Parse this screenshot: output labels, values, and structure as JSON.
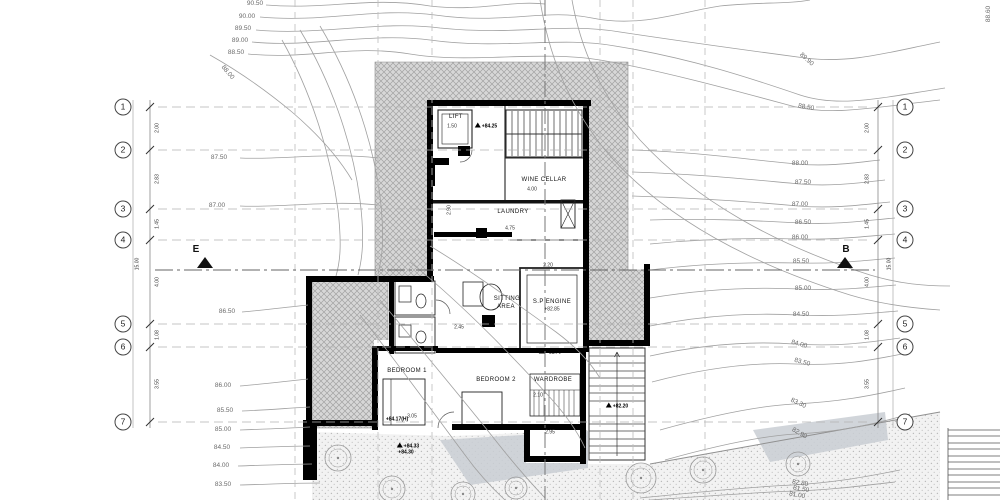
{
  "section_markers": {
    "left": "E",
    "right": "B"
  },
  "grid": {
    "row_numbers": [
      "1",
      "2",
      "3",
      "4",
      "5",
      "6",
      "7"
    ],
    "interval_dims": [
      "2.00",
      "2.83",
      "1.45",
      "4.00",
      "1.08",
      "3.55"
    ],
    "overall_dim": "15.00"
  },
  "rooms": [
    "LIFT",
    "WINE CELLAR",
    "LAUNDRY",
    "SITTING AREA",
    "S.P ENGINE",
    "BEDROOM 1",
    "BEDROOM 2",
    "WARDROBE"
  ],
  "level_markers": [
    "+84.25",
    "+82.85",
    "+82.75",
    "+82.20",
    "+84.33",
    "+84.30",
    "+84.17(H)"
  ],
  "contour_elevations": [
    "90.50",
    "90.00",
    "89.50",
    "89.00",
    "88.50",
    "88.00",
    "87.50",
    "87.00",
    "86.50",
    "86.00",
    "85.50",
    "85.00",
    "84.50",
    "84.00",
    "83.50",
    "83.30",
    "82.90",
    "82.80",
    "81.50",
    "81.00",
    "89.90",
    "88.60"
  ],
  "colors": {
    "walls": "#000000",
    "hatch": "#a2a2a2",
    "contour": "#a0a0a0",
    "ramp": "#c9ced3"
  },
  "labels": [
    {
      "t": "1",
      "x": 123,
      "y": 107,
      "c": "bubble"
    },
    {
      "t": "2",
      "x": 123,
      "y": 150,
      "c": "bubble"
    },
    {
      "t": "3",
      "x": 123,
      "y": 209,
      "c": "bubble"
    },
    {
      "t": "4",
      "x": 123,
      "y": 240,
      "c": "bubble"
    },
    {
      "t": "5",
      "x": 123,
      "y": 324,
      "c": "bubble"
    },
    {
      "t": "6",
      "x": 123,
      "y": 347,
      "c": "bubble"
    },
    {
      "t": "7",
      "x": 123,
      "y": 422,
      "c": "bubble"
    },
    {
      "t": "1",
      "x": 905,
      "y": 107,
      "c": "bubble"
    },
    {
      "t": "2",
      "x": 905,
      "y": 150,
      "c": "bubble"
    },
    {
      "t": "3",
      "x": 905,
      "y": 209,
      "c": "bubble"
    },
    {
      "t": "4",
      "x": 905,
      "y": 240,
      "c": "bubble"
    },
    {
      "t": "5",
      "x": 905,
      "y": 324,
      "c": "bubble"
    },
    {
      "t": "6",
      "x": 905,
      "y": 347,
      "c": "bubble"
    },
    {
      "t": "7",
      "x": 905,
      "y": 422,
      "c": "bubble"
    },
    {
      "t": "90.50",
      "x": 255,
      "y": 4,
      "c": "contour"
    },
    {
      "t": "90.00",
      "x": 247,
      "y": 17,
      "c": "contour"
    },
    {
      "t": "89.50",
      "x": 243,
      "y": 29,
      "c": "contour"
    },
    {
      "t": "89.00",
      "x": 240,
      "y": 41,
      "c": "contour"
    },
    {
      "t": "88.50",
      "x": 236,
      "y": 53,
      "c": "contour"
    },
    {
      "t": "88.00",
      "x": 227,
      "y": 73,
      "r": 50,
      "c": "contour"
    },
    {
      "t": "87.50",
      "x": 219,
      "y": 158,
      "c": "contour"
    },
    {
      "t": "87.00",
      "x": 217,
      "y": 206,
      "c": "contour"
    },
    {
      "t": "86.50",
      "x": 227,
      "y": 312,
      "c": "contour"
    },
    {
      "t": "86.00",
      "x": 223,
      "y": 386,
      "c": "contour"
    },
    {
      "t": "85.50",
      "x": 225,
      "y": 411,
      "c": "contour"
    },
    {
      "t": "85.00",
      "x": 223,
      "y": 430,
      "c": "contour"
    },
    {
      "t": "84.50",
      "x": 222,
      "y": 448,
      "c": "contour"
    },
    {
      "t": "84.00",
      "x": 221,
      "y": 466,
      "c": "contour"
    },
    {
      "t": "83.50",
      "x": 223,
      "y": 485,
      "c": "contour"
    },
    {
      "t": "89.90",
      "x": 806,
      "y": 60,
      "r": 42,
      "c": "contour"
    },
    {
      "t": "88.50",
      "x": 806,
      "y": 108,
      "r": 10,
      "c": "contour"
    },
    {
      "t": "88.00",
      "x": 800,
      "y": 164,
      "c": "contour"
    },
    {
      "t": "87.50",
      "x": 803,
      "y": 183,
      "c": "contour"
    },
    {
      "t": "87.00",
      "x": 800,
      "y": 205,
      "c": "contour"
    },
    {
      "t": "86.50",
      "x": 803,
      "y": 223,
      "c": "contour"
    },
    {
      "t": "86.00",
      "x": 800,
      "y": 238,
      "c": "contour"
    },
    {
      "t": "85.50",
      "x": 801,
      "y": 262,
      "c": "contour"
    },
    {
      "t": "85.00",
      "x": 803,
      "y": 289,
      "c": "contour"
    },
    {
      "t": "84.50",
      "x": 801,
      "y": 315,
      "c": "contour"
    },
    {
      "t": "84.00",
      "x": 799,
      "y": 345,
      "r": 15,
      "c": "contour"
    },
    {
      "t": "83.50",
      "x": 802,
      "y": 363,
      "r": 15,
      "c": "contour"
    },
    {
      "t": "83.30",
      "x": 798,
      "y": 404,
      "r": 25,
      "c": "contour"
    },
    {
      "t": "82.90",
      "x": 799,
      "y": 434,
      "r": 30,
      "c": "contour"
    },
    {
      "t": "82.80",
      "x": 800,
      "y": 484,
      "r": 10,
      "c": "contour"
    },
    {
      "t": "81.50",
      "x": 801,
      "y": 490,
      "r": 10,
      "c": "contour"
    },
    {
      "t": "81.00",
      "x": 797,
      "y": 496,
      "r": 10,
      "c": "contour"
    },
    {
      "t": "88.60",
      "x": 989,
      "y": 14,
      "r": -90,
      "c": "contour"
    },
    {
      "t": "LIFT",
      "x": 456,
      "y": 117,
      "c": "room"
    },
    {
      "t": "WINE CELLAR",
      "x": 544,
      "y": 180,
      "c": "room"
    },
    {
      "t": "LAUNDRY",
      "x": 513,
      "y": 212,
      "c": "room"
    },
    {
      "t": "SITTING",
      "x": 507,
      "y": 299,
      "c": "room"
    },
    {
      "t": "AREA",
      "x": 506,
      "y": 307,
      "c": "room"
    },
    {
      "t": "S.P ENGINE",
      "x": 552,
      "y": 302,
      "c": "room"
    },
    {
      "t": "+82.85",
      "x": 552,
      "y": 310,
      "c": "dim"
    },
    {
      "t": "BEDROOM 1",
      "x": 407,
      "y": 371,
      "c": "room"
    },
    {
      "t": "BEDROOM 2",
      "x": 496,
      "y": 380,
      "c": "room"
    },
    {
      "t": "WARDROBE",
      "x": 553,
      "y": 380,
      "c": "room"
    },
    {
      "t": "+84.25",
      "x": 486,
      "y": 126,
      "i": true,
      "c": "marker"
    },
    {
      "t": "+82.75",
      "x": 550,
      "y": 352,
      "i": true,
      "c": "marker"
    },
    {
      "t": "+82.20",
      "x": 617,
      "y": 406,
      "i": true,
      "c": "marker"
    },
    {
      "t": "+84.33",
      "x": 408,
      "y": 446,
      "i": true,
      "c": "marker"
    },
    {
      "t": "+84.30",
      "x": 406,
      "y": 453,
      "c": "marker"
    },
    {
      "t": "+84.17(H)",
      "x": 397,
      "y": 420,
      "c": "marker"
    },
    {
      "t": "1.50",
      "x": 452,
      "y": 127,
      "c": "dim"
    },
    {
      "t": "4.00",
      "x": 532,
      "y": 190,
      "c": "dim"
    },
    {
      "t": "4.75",
      "x": 510,
      "y": 229,
      "c": "dim"
    },
    {
      "t": "2.20",
      "x": 548,
      "y": 266,
      "c": "dim"
    },
    {
      "t": "2.45",
      "x": 459,
      "y": 328,
      "c": "dim"
    },
    {
      "t": "2.10",
      "x": 538,
      "y": 396,
      "c": "dim"
    },
    {
      "t": "2.95",
      "x": 550,
      "y": 433,
      "c": "dim"
    },
    {
      "t": "3.05",
      "x": 412,
      "y": 417,
      "c": "dim"
    },
    {
      "t": "2.90",
      "x": 450,
      "y": 210,
      "r": -90,
      "c": "dim"
    },
    {
      "t": "2.00",
      "x": 158,
      "y": 128,
      "r": -90,
      "c": "dim"
    },
    {
      "t": "2.83",
      "x": 158,
      "y": 179,
      "r": -90,
      "c": "dim"
    },
    {
      "t": "1.45",
      "x": 158,
      "y": 224,
      "r": -90,
      "c": "dim"
    },
    {
      "t": "4.00",
      "x": 158,
      "y": 282,
      "r": -90,
      "c": "dim"
    },
    {
      "t": "1.08",
      "x": 158,
      "y": 335,
      "r": -90,
      "c": "dim"
    },
    {
      "t": "3.55",
      "x": 158,
      "y": 384,
      "r": -90,
      "c": "dim"
    },
    {
      "t": "15.00",
      "x": 138,
      "y": 264,
      "r": -90,
      "c": "dim"
    },
    {
      "t": "2.00",
      "x": 868,
      "y": 128,
      "r": -90,
      "c": "dim"
    },
    {
      "t": "2.83",
      "x": 868,
      "y": 179,
      "r": -90,
      "c": "dim"
    },
    {
      "t": "1.45",
      "x": 868,
      "y": 224,
      "r": -90,
      "c": "dim"
    },
    {
      "t": "4.00",
      "x": 868,
      "y": 282,
      "r": -90,
      "c": "dim"
    },
    {
      "t": "1.08",
      "x": 868,
      "y": 335,
      "r": -90,
      "c": "dim"
    },
    {
      "t": "3.55",
      "x": 868,
      "y": 384,
      "r": -90,
      "c": "dim"
    },
    {
      "t": "15.00",
      "x": 890,
      "y": 264,
      "r": -90,
      "c": "dim"
    }
  ]
}
